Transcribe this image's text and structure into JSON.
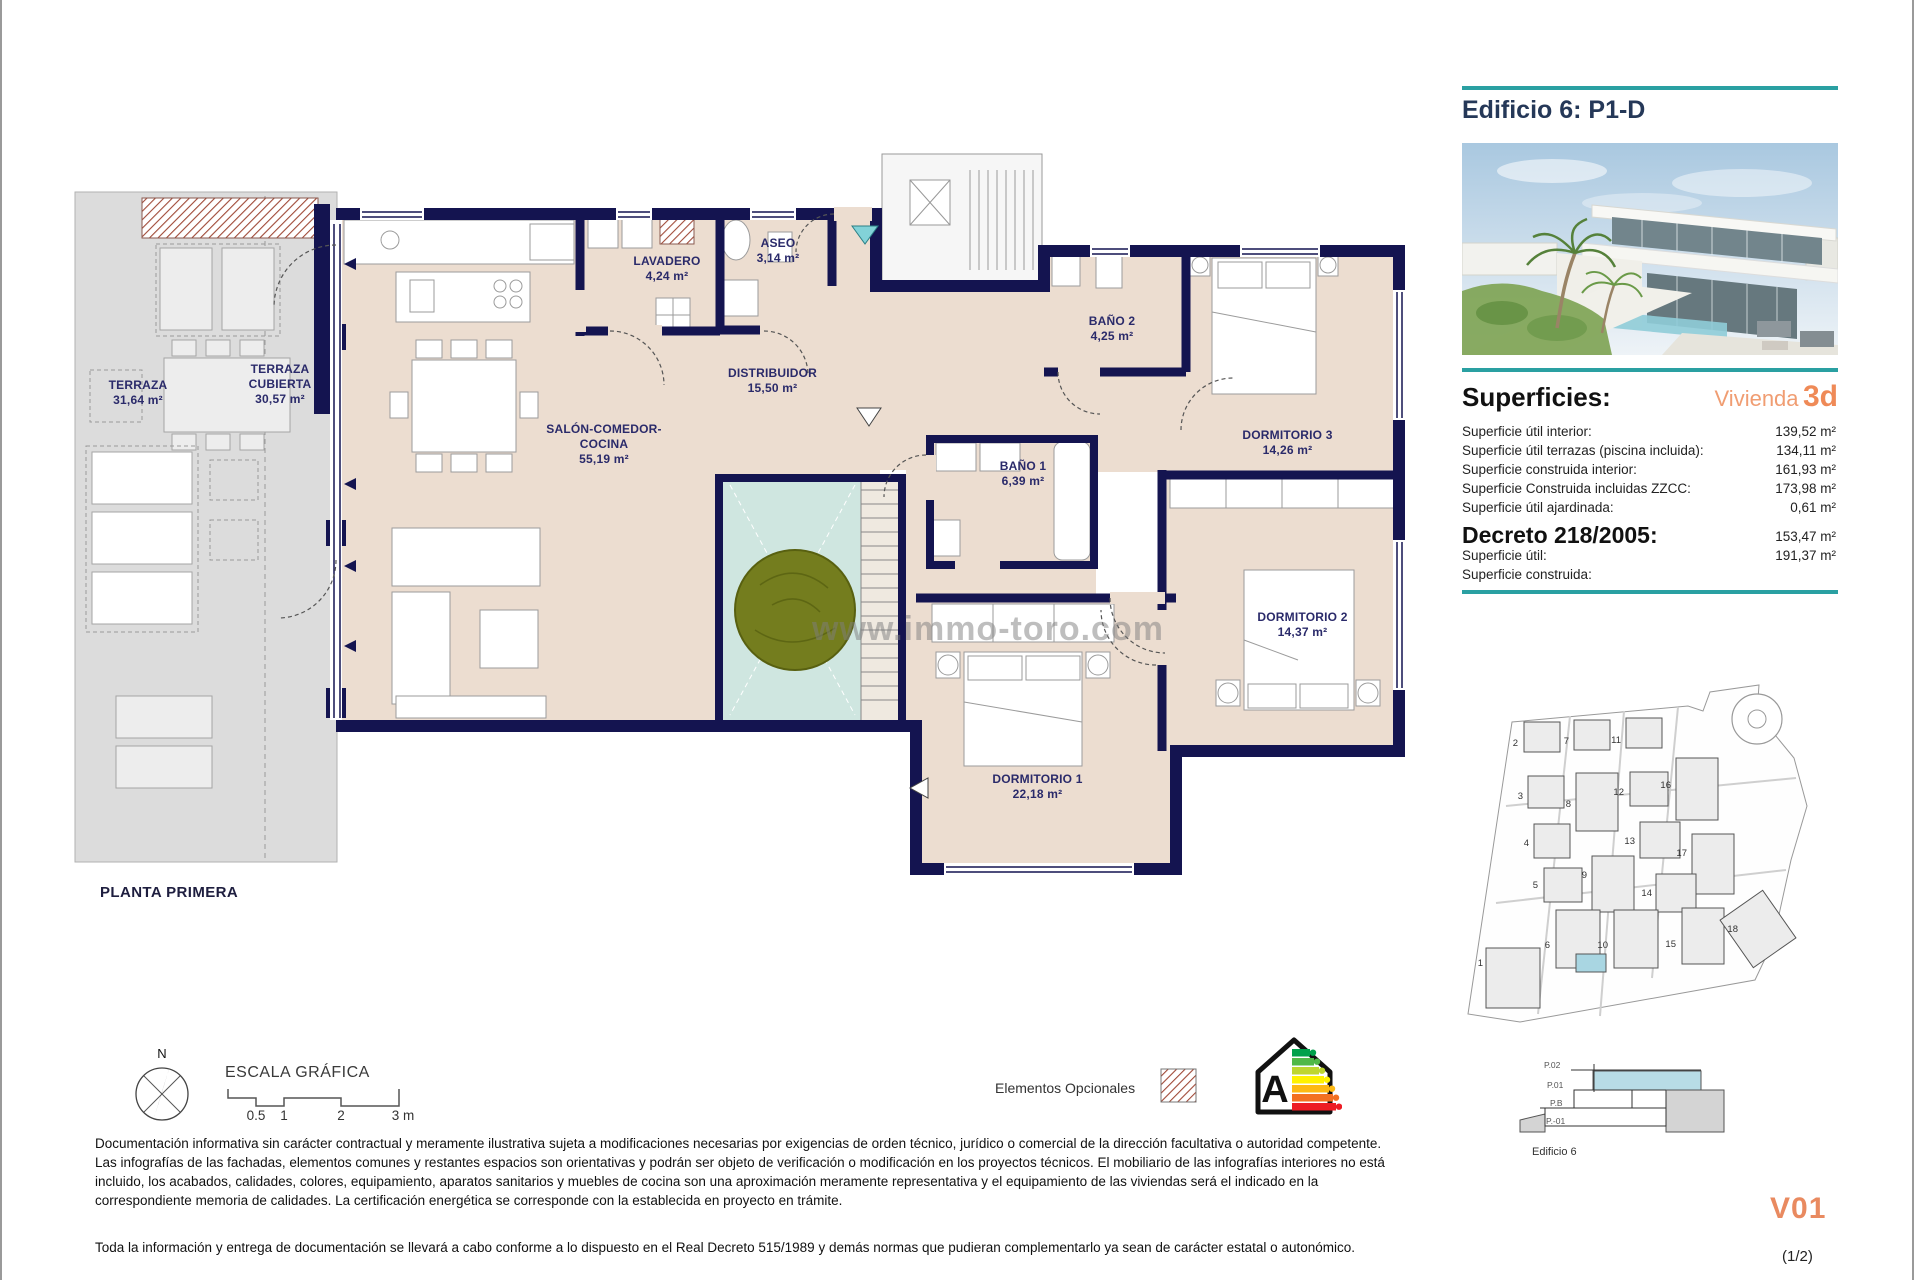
{
  "sheet": {
    "title": "Edificio 6: P1-D",
    "floor_label": "PLANTA PRIMERA",
    "version": "V01",
    "page": "(1/2)"
  },
  "superficies": {
    "title": "Superficies:",
    "vivienda_label": "Vivienda",
    "vivienda_code": "3d",
    "rows": [
      {
        "label": "Superficie útil interior:",
        "value": "139,52 m²"
      },
      {
        "label": "Superficie útil terrazas (piscina incluida):",
        "value": "134,11 m²"
      },
      {
        "label": "Superficie construida interior:",
        "value": "161,93 m²"
      },
      {
        "label": "Superficie Construida incluidas ZZCC:",
        "value": "173,98 m²"
      },
      {
        "label": "Superficie útil ajardinada:",
        "value": "0,61 m²"
      }
    ],
    "decreto": {
      "title": "Decreto 218/2005:",
      "rows": [
        {
          "label": "Superficie útil:",
          "value": "153,47 m²"
        },
        {
          "label": "Superficie construida:",
          "value": "191,37 m²"
        }
      ]
    }
  },
  "plan": {
    "watermark": "www.immo-toro.com",
    "rooms": [
      {
        "name": "TERRAZA",
        "area": "31,64 m²"
      },
      {
        "name": "TERRAZA CUBIERTA",
        "area": "30,57 m²"
      },
      {
        "name": "LAVADERO",
        "area": "4,24 m²"
      },
      {
        "name": "ASEO",
        "area": "3,14 m²"
      },
      {
        "name": "SALÓN-COMEDOR-COCINA",
        "area": "55,19 m²"
      },
      {
        "name": "DISTRIBUIDOR",
        "area": "15,50 m²"
      },
      {
        "name": "BAÑO 2",
        "area": "4,25 m²"
      },
      {
        "name": "BAÑO 1",
        "area": "6,39 m²"
      },
      {
        "name": "DORMITORIO 3",
        "area": "14,26 m²"
      },
      {
        "name": "DORMITORIO 2",
        "area": "14,37 m²"
      },
      {
        "name": "DORMITORIO 1",
        "area": "22,18 m²"
      }
    ]
  },
  "legend": {
    "escala_title": "ESCALA GRÁFICA",
    "escala_ticks": [
      "0.5",
      "1",
      "2",
      "3 m"
    ],
    "north_label": "N",
    "optional_label": "Elementos Opcionales",
    "energy_letter": "A"
  },
  "site": {
    "numbers": [
      "1",
      "2",
      "3",
      "4",
      "5",
      "6",
      "7",
      "8",
      "9",
      "10",
      "11",
      "12",
      "13",
      "14",
      "15",
      "16",
      "17",
      "18"
    ]
  },
  "elevation": {
    "levels": [
      "P.02",
      "P.01",
      "P.B",
      "P.-01"
    ],
    "caption": "Edificio 6"
  },
  "disclaimer": {
    "p1": "Documentación informativa sin carácter contractual y meramente ilustrativa sujeta a modificaciones necesarias por exigencias de orden técnico, jurídico o comercial de la dirección facultativa o autoridad competente. Las infografías de las fachadas, elementos comunes y restantes espacios son orientativas y podrán ser objeto de verificación o modificación en los proyectos técnicos. El mobiliario de las infografías interiores no está incluido, los acabados, calidades, colores, equipamiento, aparatos sanitarios y muebles de cocina son una aproximación meramente representativa y el equipamiento de las viviendas será el indicado en la correspondiente memoria de calidades. La certificación energética se corresponde con la establecida en proyecto en trámite.",
    "p2": "Toda la información y entrega de documentación se llevará a cabo conforme a lo dispuesto en el Real Decreto 515/1989 y demás normas que pudieran complementarlo ya sean de carácter estatal o autonómico."
  },
  "colors": {
    "accent_teal": "#2AA0A2",
    "accent_orange": "#EF8A57",
    "wall_navy": "#141450",
    "floor_beige": "#ECDDD0",
    "terrace_gray": "#DCDCDC",
    "patio_green": "#CFE6E0",
    "site_highlight": "#A9D6E2",
    "hatch_red": "#A04A38"
  }
}
